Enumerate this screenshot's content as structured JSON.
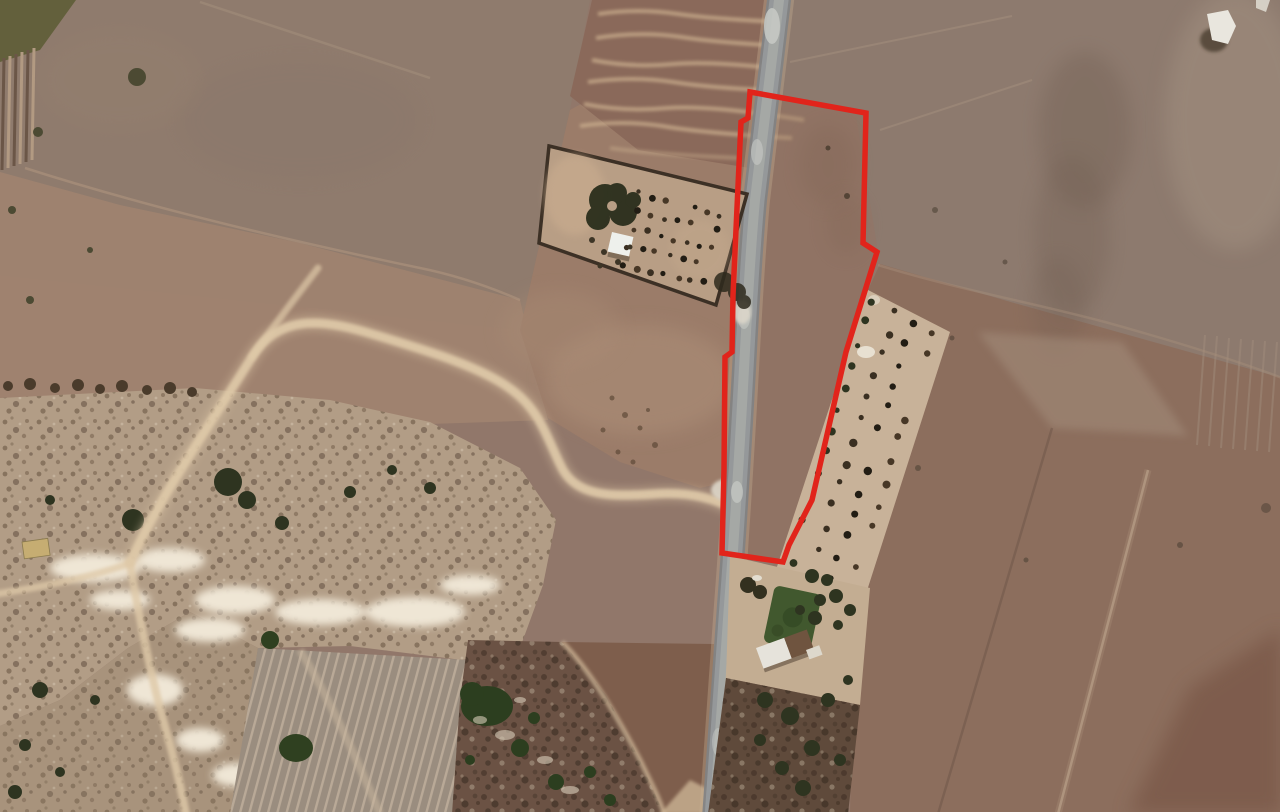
{
  "meta": {
    "view_type": "satellite-aerial-imagery",
    "scene": "Rural agricultural land with dirt tracks, a walled cemetery enclosure, an olive-tree orchard strip, a farmstead and a paved road; a land parcel is outlined in red",
    "text_on_screen": "none"
  },
  "colors": {
    "parcel_outline": "#e1241b",
    "road_surface": "#95989a",
    "road_shoulder": "#c9b394",
    "dirt_track": "#dfc9a8",
    "field_base": "#91776a",
    "rocky_ground": "#b29d86",
    "vegetation_dark": "#2e3420",
    "paddock_green": "#41582e",
    "enclosure_interior": "#b89e85",
    "orchard_soil": "#c8b299"
  },
  "parcel": {
    "outline_color": "#e1241b",
    "outline_width": "5.5",
    "points": "750,92 866,113 863,243 877,252 846,352 812,500 789,545 783,562 722,553 724,470 725,357 732,352 733,295 737,208 741,122 748,118"
  },
  "road": {
    "d": "M 780,-8 C 773,55 763,130 755,200 C 749,265 746,335 742,405 C 738,475 734,540 729,605 C 724,675 719,745 714,818",
    "color": "#95989a",
    "shoulder_color": "#c9b394",
    "center_color": "#a9aca8"
  },
  "tracks": {
    "color": "#dfc9a8",
    "main": "M 130,563 C 158,500 205,432 252,357 C 278,315 320,318 372,334 C 428,351 482,367 512,390 C 542,412 548,442 563,470 C 578,496 610,497 655,494 C 685,492 712,497 733,509",
    "north_spur": "M 252,357 C 272,328 295,298 318,268",
    "south_branch": "M 130,563 C 138,612 152,682 166,730 C 175,762 181,788 186,814",
    "west_branch": "M 130,563 C 96,576 48,586 -4,594"
  },
  "features": {
    "parcel_boundary": "red outlined land plot along road",
    "cemetery_enclosure": "walled rectangular enclosure with trees and white building",
    "orchard_strip": "narrow strip with rows of trees",
    "farmstead": "farm buildings, green paddock and tree yard",
    "rocky_scrubland": "light rocky scrub area with bushes",
    "furrowed_field": "plowed field with furrow lines",
    "dirt_tracks": "light dirt tracks crossing fields",
    "road": "paved rural road running north-south"
  }
}
